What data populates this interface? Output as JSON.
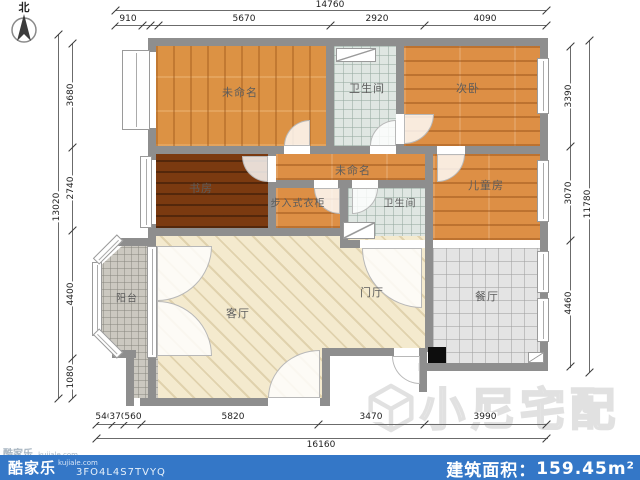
{
  "meta": {
    "compass_label": "北"
  },
  "rooms": [
    {
      "id": "unnamed-top",
      "label": "未命名"
    },
    {
      "id": "bathroom-top",
      "label": "卫生间"
    },
    {
      "id": "second-bedroom",
      "label": "次卧"
    },
    {
      "id": "study",
      "label": "书房"
    },
    {
      "id": "unnamed-mid",
      "label": "未命名"
    },
    {
      "id": "walkin-closet",
      "label": "步入式衣柜"
    },
    {
      "id": "bathroom-mid",
      "label": "卫生间"
    },
    {
      "id": "kids-room",
      "label": "儿童房"
    },
    {
      "id": "balcony",
      "label": "阳台"
    },
    {
      "id": "living-room",
      "label": "客厅"
    },
    {
      "id": "entry-hall",
      "label": "门厅"
    },
    {
      "id": "dining-room",
      "label": "餐厅"
    }
  ],
  "dimensions": {
    "top": {
      "total": "14760",
      "segments": [
        "910",
        "5670",
        "2920",
        "4090"
      ]
    },
    "bottom": {
      "total": "16160",
      "segments": [
        "540",
        "370",
        "560",
        "5820",
        "3470",
        "3990"
      ]
    },
    "left": {
      "total": "13020",
      "segments": [
        "3680",
        "2740",
        "4400",
        "1080"
      ]
    },
    "right": {
      "total": "11780",
      "segments": [
        "3390",
        "3070",
        "4460"
      ]
    }
  },
  "watermark": {
    "text": "小尼宅配"
  },
  "corner_watermark": {
    "brand": "酷家乐",
    "domain": "kujiale.com"
  },
  "footer": {
    "brand": "酷家乐",
    "domain": "kujiale.com",
    "plan_code": "3FO4L4S7TVYQ",
    "area_label": "建筑面积：",
    "area_value": "159.45",
    "area_unit": "m²",
    "bar_color": "#3477C7"
  }
}
